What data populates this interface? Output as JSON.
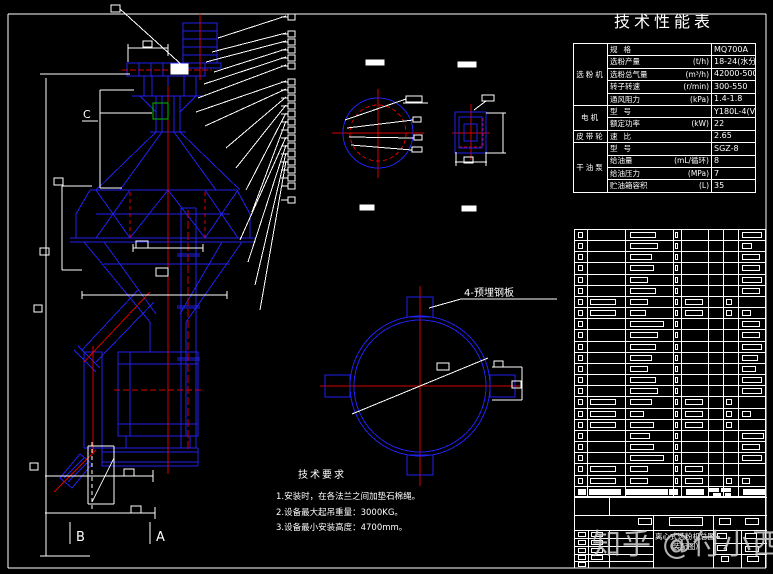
{
  "watermark": "知乎 @付小西",
  "colors": {
    "background": "#000000",
    "line_blue": "#2121ee",
    "centerline_red": "#d40000",
    "dim_white": "#ffffff",
    "highlight_green": "#00bb00",
    "watermark_gray": "#cfcfcf"
  },
  "performance_table": {
    "title": "技术性能表",
    "rows": [
      {
        "group": "选粉机",
        "span": 5,
        "item": "规格",
        "unit": "",
        "value": "MQ700A"
      },
      {
        "item": "选粉产量",
        "unit": "(t/h)",
        "value": "18-24(水分6%)"
      },
      {
        "item": "选粉总气量",
        "unit": "(m³/h)",
        "value": "42000-50000"
      },
      {
        "item": "转子转速",
        "unit": "(r/min)",
        "value": "300-550"
      },
      {
        "item": "通风阻力",
        "unit": "(kPa)",
        "value": "1.4-1.8"
      },
      {
        "group": "电机",
        "span": 2,
        "item": "型号",
        "unit": "",
        "value": "Y180L-4(V5)"
      },
      {
        "item": "额定功率",
        "unit": "(kW)",
        "value": "22"
      },
      {
        "group": "皮带轮",
        "span": 1,
        "item": "速比",
        "unit": "",
        "value": "2.65"
      },
      {
        "group": "干油泵",
        "span": 4,
        "item": "型号",
        "unit": "",
        "value": "SGZ-8"
      },
      {
        "item": "给油量",
        "unit": "(mL/循环)",
        "value": "8"
      },
      {
        "item": "给油压力",
        "unit": "(MPa)",
        "value": "7"
      },
      {
        "item": "贮油箱容积",
        "unit": "(L)",
        "value": "35"
      }
    ]
  },
  "notes": {
    "title": "技术要求",
    "lines": [
      "1.安装时，在各法兰之间加垫石棉绳。",
      "2.设备最大起吊重量：3000KG。",
      "3.设备最小安装高度：4700mm。"
    ]
  },
  "drawing_labels": {
    "embedded_plates": "4-预埋钢板",
    "section_a": "A",
    "section_b": "B",
    "section_c": "C"
  },
  "title_block": {
    "drawing_title_line1": "离心式选粉机总图",
    "drawing_title_line2": "（装配图）"
  },
  "bom": {
    "rows": [
      [
        0,
        26,
        0,
        0,
        20
      ],
      [
        0,
        28,
        0,
        0,
        10
      ],
      [
        0,
        22,
        0,
        0,
        18
      ],
      [
        0,
        24,
        0,
        0,
        18
      ],
      [
        0,
        18,
        0,
        0,
        20
      ],
      [
        0,
        26,
        0,
        0,
        18
      ],
      [
        1,
        18,
        1,
        1,
        0
      ],
      [
        1,
        16,
        1,
        1,
        9
      ],
      [
        0,
        34,
        0,
        0,
        18
      ],
      [
        0,
        28,
        0,
        0,
        18
      ],
      [
        0,
        26,
        0,
        0,
        20
      ],
      [
        0,
        22,
        0,
        0,
        16
      ],
      [
        0,
        18,
        0,
        0,
        14
      ],
      [
        0,
        26,
        0,
        0,
        20
      ],
      [
        0,
        28,
        0,
        0,
        20
      ],
      [
        1,
        22,
        1,
        1,
        0
      ],
      [
        1,
        14,
        1,
        1,
        9
      ],
      [
        1,
        24,
        1,
        1,
        0
      ],
      [
        0,
        20,
        0,
        0,
        22
      ],
      [
        0,
        24,
        0,
        0,
        18
      ],
      [
        0,
        34,
        0,
        0,
        20
      ],
      [
        1,
        18,
        1,
        0,
        0
      ],
      [
        1,
        18,
        1,
        1,
        8
      ]
    ]
  }
}
